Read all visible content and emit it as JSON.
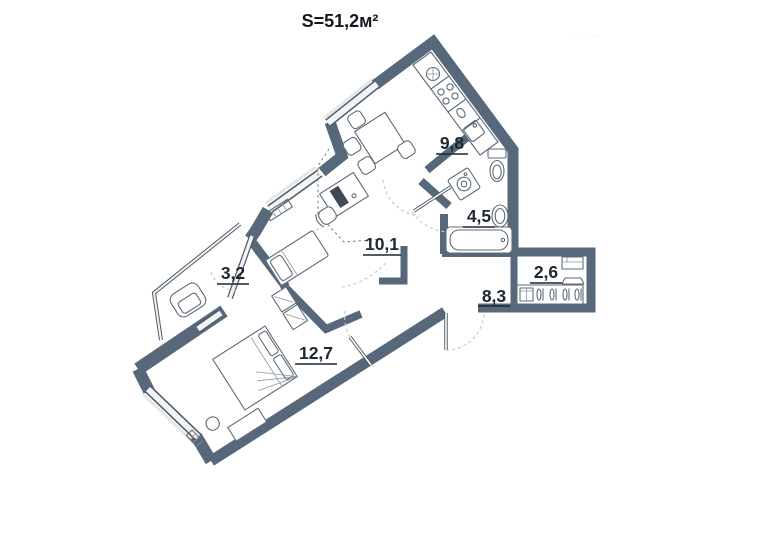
{
  "title": "S=51,2м²",
  "watermark": "·· ··· ·· ····",
  "rooms": [
    {
      "name": "kitchen",
      "area": "9,8"
    },
    {
      "name": "bathroom",
      "area": "4,5"
    },
    {
      "name": "room",
      "area": "10,1"
    },
    {
      "name": "balcony",
      "area": "3,2"
    },
    {
      "name": "wardrobe",
      "area": "2,6"
    },
    {
      "name": "hallway",
      "area": "8,3"
    },
    {
      "name": "bedroom",
      "area": "12,7"
    }
  ],
  "colors": {
    "wall": "#566879",
    "label": "#1f2733",
    "window_core": "#f3f4f5"
  }
}
